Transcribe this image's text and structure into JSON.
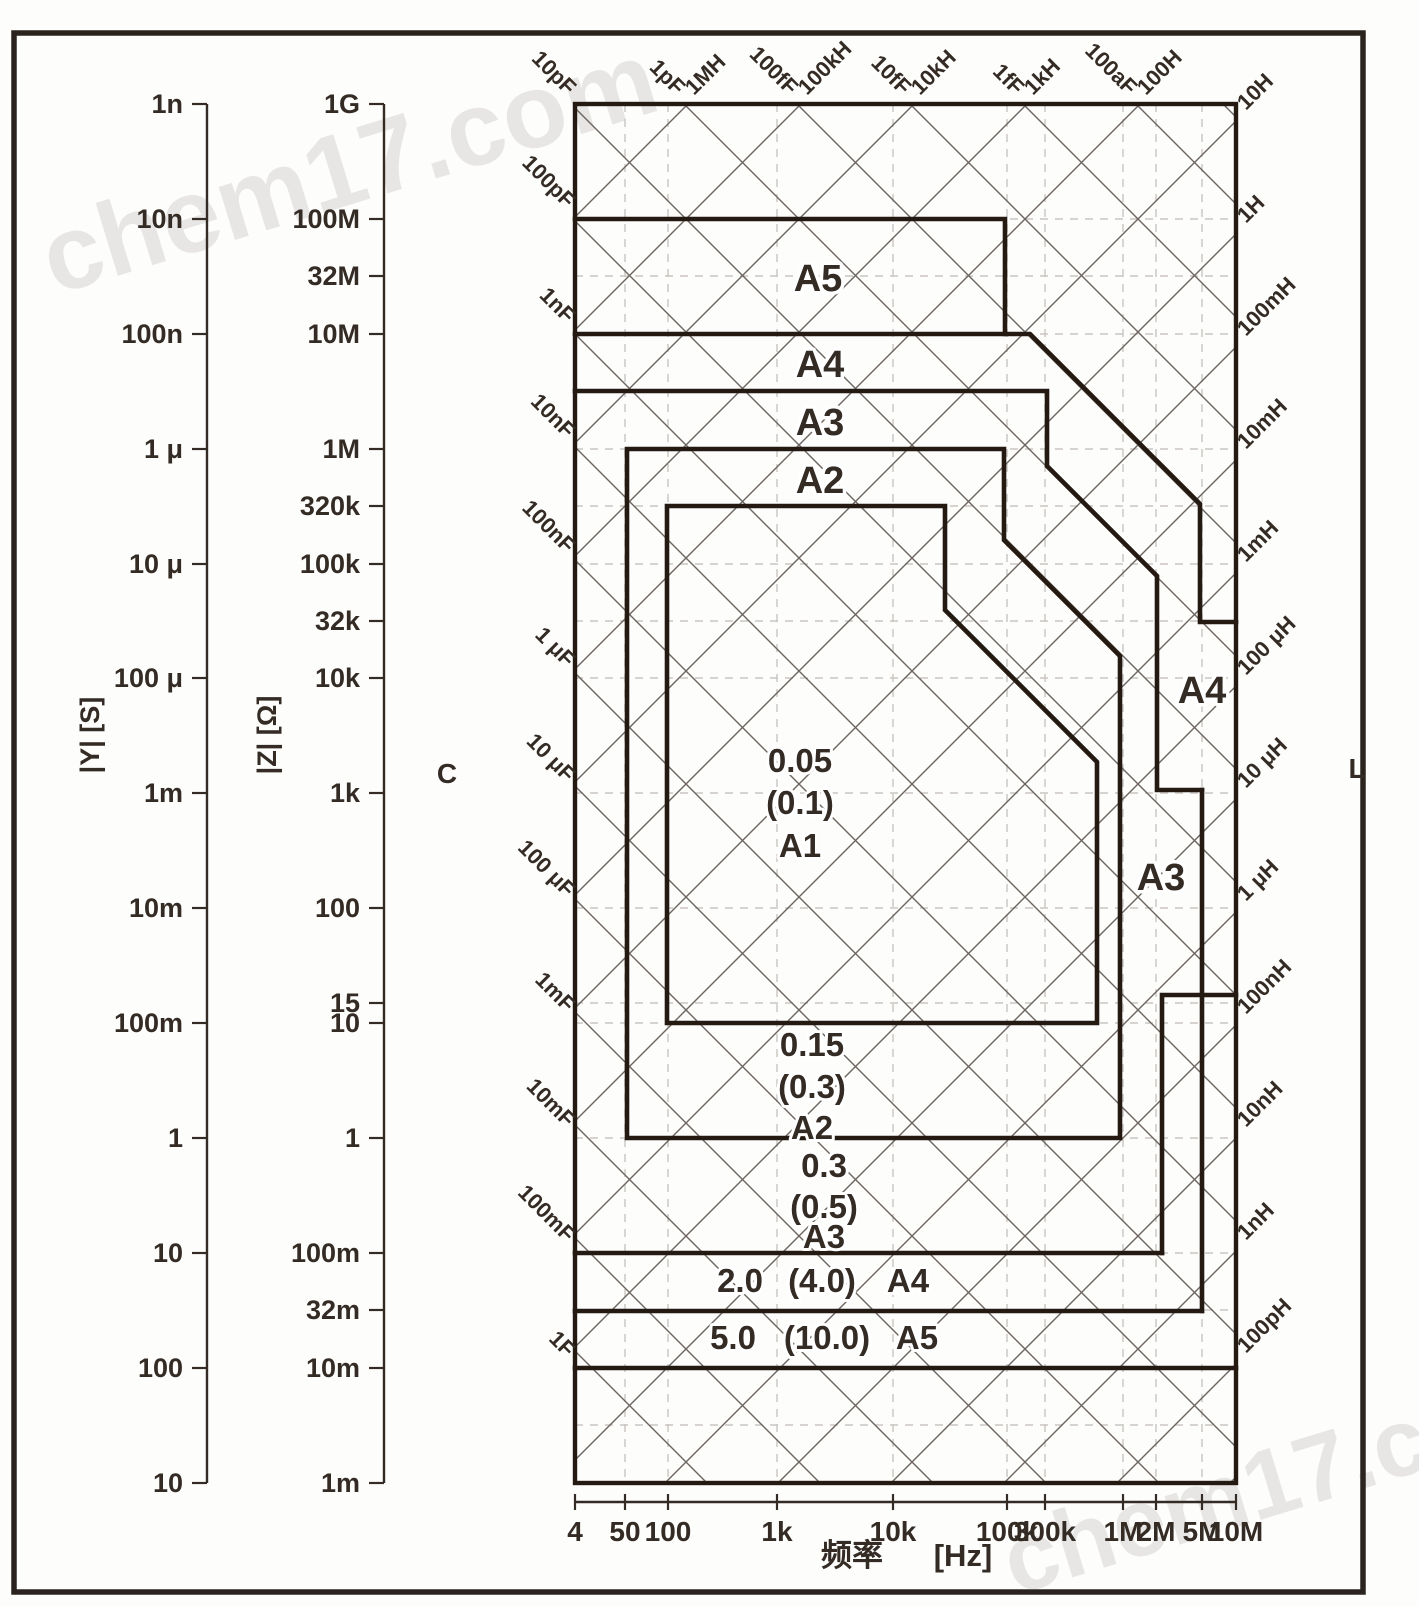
{
  "watermark": {
    "text": "chem17.com",
    "color": "#8a8a84",
    "opacity": 0.1
  },
  "colors": {
    "boundary": "#241a12",
    "lattice": "#6d6660",
    "dashed": "#c9c5c1",
    "axis": "#332b24",
    "text": "#332b24",
    "background": "#fdfdfc"
  },
  "chart_data": {
    "type": "region-map",
    "title": "",
    "frequency_axis": {
      "title": "频率",
      "unit": "[Hz]",
      "ticks": [
        [
          "4",
          575
        ],
        [
          "50",
          625
        ],
        [
          "100",
          668
        ],
        [
          "1k",
          777
        ],
        [
          "10k",
          893
        ],
        [
          "100k",
          1007
        ],
        [
          "300k",
          1045
        ],
        [
          "1M",
          1123
        ],
        [
          "2M",
          1156
        ],
        [
          "5M",
          1202
        ],
        [
          "10M",
          1236
        ]
      ]
    },
    "admittance_axis": {
      "title": "|Y|  [S]",
      "x": 207,
      "labels": [
        [
          "1n",
          104
        ],
        [
          "10n",
          219
        ],
        [
          "100n",
          334
        ],
        [
          "1 μ",
          449
        ],
        [
          "10 μ",
          564
        ],
        [
          "100 μ",
          678
        ],
        [
          "1m",
          793
        ],
        [
          "10m",
          908
        ],
        [
          "100m",
          1023
        ],
        [
          "1",
          1138
        ],
        [
          "10",
          1253
        ],
        [
          "100",
          1368
        ],
        [
          "10",
          1483
        ]
      ]
    },
    "impedance_axis": {
      "title": "|Z|  [Ω]",
      "x": 384,
      "labels": [
        [
          "1G",
          104
        ],
        [
          "100M",
          219
        ],
        [
          "10M",
          334
        ],
        [
          "1M",
          449
        ],
        [
          "100k",
          564
        ],
        [
          "10k",
          678
        ],
        [
          "1k",
          793
        ],
        [
          "100",
          908
        ],
        [
          "10",
          1023
        ],
        [
          "1",
          1138
        ],
        [
          "100m",
          1253
        ],
        [
          "10m",
          1368
        ],
        [
          "1m",
          1483
        ]
      ],
      "extra_labels": [
        [
          "32M",
          276
        ],
        [
          "320k",
          506
        ],
        [
          "32k",
          621
        ],
        [
          "15",
          1003
        ],
        [
          "32m",
          1310
        ]
      ]
    },
    "capacitance_axis_label": "C",
    "inductance_axis_label": "L",
    "top_capacitance_lines": [
      [
        "10pF",
        575
      ],
      [
        "1pF",
        684
      ],
      [
        "100fF",
        797
      ],
      [
        "10fF",
        910
      ],
      [
        "1fF",
        1023
      ],
      [
        "100aF",
        1136
      ]
    ],
    "top_inductance_lines": [
      [
        "1MH",
        684
      ],
      [
        "100kH",
        797
      ],
      [
        "10kH",
        910
      ],
      [
        "1kH",
        1023
      ],
      [
        "100H",
        1136
      ]
    ],
    "left_capacitance_lines": [
      [
        "100pF",
        219
      ],
      [
        "1nF",
        334
      ],
      [
        "10nF",
        449
      ],
      [
        "100nF",
        564
      ],
      [
        "1 μF",
        678
      ],
      [
        "10 μF",
        793
      ],
      [
        "100 μF",
        908
      ],
      [
        "1mF",
        1023
      ],
      [
        "10mF",
        1138
      ],
      [
        "100mF",
        1253
      ],
      [
        "1F",
        1368
      ]
    ],
    "right_inductance_lines": [
      [
        "10H",
        117
      ],
      [
        "1H",
        230
      ],
      [
        "100mH",
        343
      ],
      [
        "10mH",
        456
      ],
      [
        "1mH",
        569
      ],
      [
        "100 μH",
        682
      ],
      [
        "10 μH",
        795
      ],
      [
        "1 μH",
        908
      ],
      [
        "100nH",
        1021
      ],
      [
        "10nH",
        1134
      ],
      [
        "1nH",
        1247
      ],
      [
        "100pH",
        1360
      ]
    ],
    "region_boundaries": [
      {
        "name": "A5-top",
        "closed": false,
        "points": [
          [
            575,
            219
          ],
          [
            1005,
            219
          ],
          [
            1005,
            334
          ]
        ]
      },
      {
        "name": "A4-top",
        "closed": false,
        "points": [
          [
            575,
            334
          ],
          [
            1030,
            334
          ],
          [
            1200,
            504
          ],
          [
            1200,
            622
          ],
          [
            1236,
            622
          ]
        ]
      },
      {
        "name": "A3-top",
        "closed": false,
        "points": [
          [
            575,
            391
          ],
          [
            1047,
            391
          ],
          [
            1047,
            466
          ],
          [
            1157,
            576
          ],
          [
            1157,
            790
          ],
          [
            1202,
            790
          ]
        ]
      },
      {
        "name": "right-shared-vertical",
        "closed": false,
        "points": [
          [
            1202,
            790
          ],
          [
            1202,
            1311
          ]
        ]
      },
      {
        "name": "A3-right-step",
        "closed": false,
        "points": [
          [
            1202,
            995
          ],
          [
            1162,
            995
          ],
          [
            1162,
            1253
          ]
        ]
      },
      {
        "name": "A4-right-step",
        "closed": false,
        "points": [
          [
            1202,
            995
          ],
          [
            1236,
            995
          ]
        ]
      },
      {
        "name": "A3-bottom",
        "closed": false,
        "points": [
          [
            575,
            1253
          ],
          [
            1162,
            1253
          ]
        ]
      },
      {
        "name": "A5-row-top",
        "closed": false,
        "points": [
          [
            575,
            1311
          ],
          [
            1202,
            1311
          ]
        ]
      },
      {
        "name": "A5-bottom",
        "closed": false,
        "points": [
          [
            575,
            1368
          ],
          [
            1236,
            1368
          ]
        ]
      },
      {
        "name": "A2-box",
        "closed": true,
        "points": [
          [
            627,
            449
          ],
          [
            1004,
            449
          ],
          [
            1004,
            540
          ],
          [
            1120,
            656
          ],
          [
            1120,
            1138
          ],
          [
            627,
            1138
          ]
        ]
      },
      {
        "name": "A1-box",
        "closed": true,
        "points": [
          [
            667,
            506
          ],
          [
            945,
            506
          ],
          [
            945,
            610
          ],
          [
            1097,
            762
          ],
          [
            1097,
            1023
          ],
          [
            667,
            1023
          ]
        ]
      }
    ],
    "region_labels": [
      {
        "text": "A5",
        "x": 818,
        "y": 291,
        "size": 38
      },
      {
        "text": "A4",
        "x": 820,
        "y": 377,
        "size": 38
      },
      {
        "text": "A3",
        "x": 820,
        "y": 435,
        "size": 38
      },
      {
        "text": "A2",
        "x": 820,
        "y": 493,
        "size": 38
      },
      {
        "text": "A4",
        "x": 1202,
        "y": 703,
        "size": 38
      },
      {
        "text": "A3",
        "x": 1161,
        "y": 890,
        "size": 38
      }
    ],
    "accuracy_labels": [
      {
        "text": "0.05",
        "x": 800,
        "y": 772,
        "size": 33
      },
      {
        "text": "(0.1)",
        "x": 800,
        "y": 814,
        "size": 33
      },
      {
        "text": "A1",
        "x": 800,
        "y": 857,
        "size": 33
      },
      {
        "text": "0.15",
        "x": 812,
        "y": 1056,
        "size": 33
      },
      {
        "text": "(0.3)",
        "x": 812,
        "y": 1098,
        "size": 33
      },
      {
        "text": "A2",
        "x": 812,
        "y": 1139,
        "size": 33
      },
      {
        "text": "0.3",
        "x": 824,
        "y": 1177,
        "size": 33
      },
      {
        "text": "(0.5)",
        "x": 824,
        "y": 1218,
        "size": 33
      },
      {
        "text": "A3",
        "x": 824,
        "y": 1248,
        "size": 33
      },
      {
        "text": "2.0",
        "x": 740,
        "y": 1292,
        "size": 33
      },
      {
        "text": "(4.0)",
        "x": 822,
        "y": 1292,
        "size": 33
      },
      {
        "text": "A4",
        "x": 908,
        "y": 1292,
        "size": 33
      },
      {
        "text": "5.0",
        "x": 733,
        "y": 1349,
        "size": 33
      },
      {
        "text": "(10.0)",
        "x": 827,
        "y": 1349,
        "size": 33
      },
      {
        "text": "A5",
        "x": 917,
        "y": 1349,
        "size": 33
      }
    ]
  },
  "layout": {
    "canvas": {
      "w": 1419,
      "h": 1606
    },
    "page_border": {
      "x": 14,
      "y": 33,
      "w": 1349,
      "h": 1559,
      "stroke_w": 5.5
    },
    "plot": {
      "x0": 575,
      "y0": 104,
      "x1": 1236,
      "y1": 1483
    },
    "decades_y": [
      104,
      219,
      334,
      449,
      564,
      678,
      793,
      908,
      1023,
      1138,
      1253,
      1368,
      1483
    ],
    "dashed_x": [
      625,
      668,
      777,
      893,
      1007,
      1045,
      1123,
      1156,
      1202
    ],
    "dashed_y": [
      219,
      276,
      334,
      449,
      506,
      564,
      621,
      678,
      793,
      908,
      1003,
      1023,
      1138,
      1253,
      1310,
      1368,
      1425
    ],
    "lattice": {
      "c_start": 679,
      "c_step": 113,
      "c_count": 19,
      "d_values": [
        -776,
        -663,
        -550,
        -437,
        -324,
        -211,
        -98,
        15,
        128,
        241,
        354,
        467,
        580,
        693,
        806,
        919,
        1032,
        1119
      ]
    },
    "x_ruler_y": 1502,
    "x_label_y": 1541,
    "freq_title_pos": {
      "cjk_x": 852,
      "unit_x": 963,
      "y": 1566
    },
    "axis_title_y": 735,
    "c_label_pos": {
      "x": 447,
      "y": 783
    },
    "l_label_pos": {
      "x": 1357,
      "y": 778
    }
  }
}
